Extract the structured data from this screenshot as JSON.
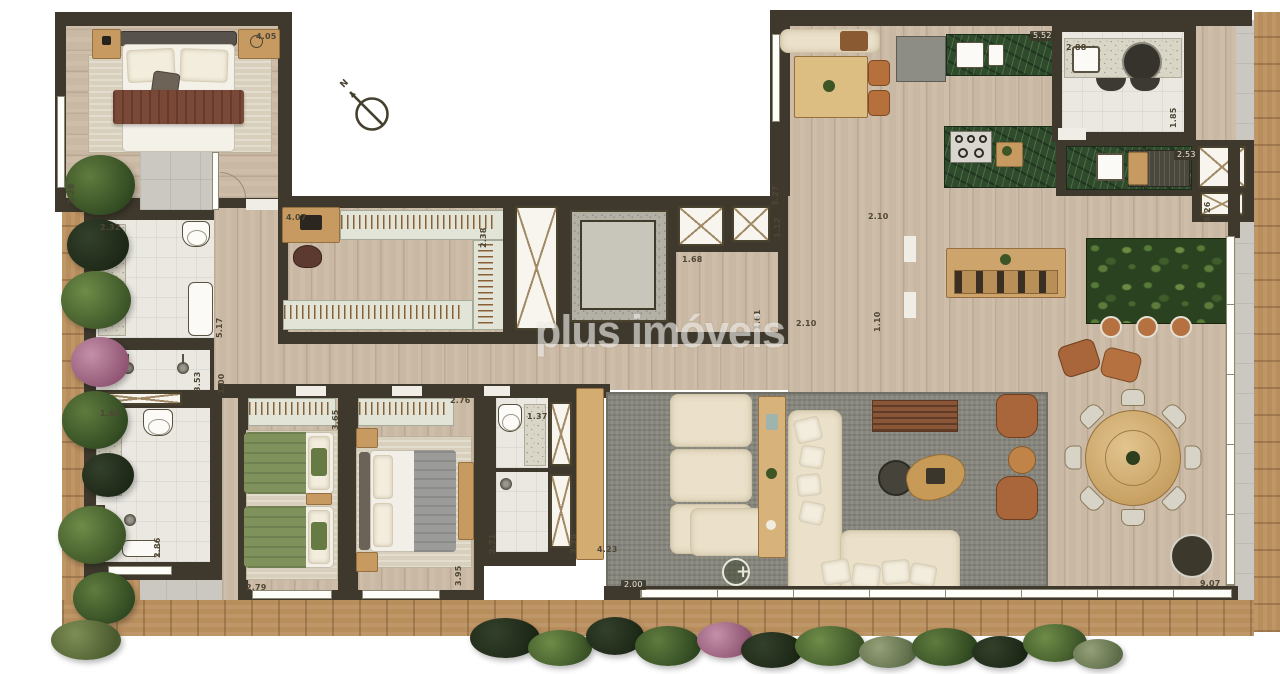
{
  "watermark": "plus imóveis",
  "compass": {
    "label": "N"
  },
  "garden_marker": "+",
  "colors": {
    "wall": "#3e392c",
    "wood": "#c9b8a3",
    "wood2": "#c79a62",
    "deck": "#b98e5d",
    "tile": "#cac8c1",
    "wtile": "#eae8e1",
    "marble": "#2e4b2c",
    "grass": "#2b3d1d",
    "ruggray": "#87877e",
    "rugbeige": "#d8d0bc",
    "sofa": "#ebe1ca",
    "bedgreen": "#7f925c",
    "bedgray": "#9b9b99",
    "blanket": "#7a4836",
    "watermark_color": "#ffffff"
  },
  "dimensions": [
    {
      "value": "4.05",
      "x": 256,
      "y": 33
    },
    {
      "value": "3.28",
      "x": 76,
      "y": 196,
      "rot": 1
    },
    {
      "value": "2.32",
      "x": 100,
      "y": 224
    },
    {
      "value": "4.07",
      "x": 286,
      "y": 214
    },
    {
      "value": "2.38",
      "x": 488,
      "y": 240,
      "rot": 1
    },
    {
      "value": "5.17",
      "x": 224,
      "y": 330,
      "rot": 1
    },
    {
      "value": "1.68",
      "x": 682,
      "y": 256
    },
    {
      "value": "3.27",
      "x": 780,
      "y": 198,
      "rot": 1
    },
    {
      "value": "1.12",
      "x": 782,
      "y": 230,
      "rot": 1
    },
    {
      "value": "2.10",
      "x": 868,
      "y": 213
    },
    {
      "value": "2.10",
      "x": 796,
      "y": 320
    },
    {
      "value": "1.10",
      "x": 882,
      "y": 324,
      "rot": 1
    },
    {
      "value": "1.61",
      "x": 762,
      "y": 322,
      "rot": 1
    },
    {
      "value": "5.52",
      "x": 1030,
      "y": 31,
      "tag": 1
    },
    {
      "value": "2.88",
      "x": 1066,
      "y": 44
    },
    {
      "value": "1.85",
      "x": 1178,
      "y": 120,
      "rot": 1
    },
    {
      "value": "2.53",
      "x": 1174,
      "y": 150,
      "tag": 1
    },
    {
      "value": "8.26",
      "x": 1212,
      "y": 214,
      "rot": 1
    },
    {
      "value": "3.53",
      "x": 202,
      "y": 384,
      "rot": 1
    },
    {
      "value": "1.00",
      "x": 226,
      "y": 386,
      "rot": 1
    },
    {
      "value": "1.64",
      "x": 100,
      "y": 410
    },
    {
      "value": "2.86",
      "x": 162,
      "y": 550,
      "rot": 1
    },
    {
      "value": "2.79",
      "x": 246,
      "y": 584
    },
    {
      "value": "3.65",
      "x": 340,
      "y": 422,
      "rot": 1
    },
    {
      "value": "2.76",
      "x": 450,
      "y": 397
    },
    {
      "value": "1.37",
      "x": 527,
      "y": 413
    },
    {
      "value": "2.71",
      "x": 497,
      "y": 546,
      "rot": 1
    },
    {
      "value": "3.38",
      "x": 578,
      "y": 546,
      "rot": 1
    },
    {
      "value": "4.23",
      "x": 597,
      "y": 546
    },
    {
      "value": "2.00",
      "x": 621,
      "y": 580,
      "tag": 1
    },
    {
      "value": "9.07",
      "x": 1200,
      "y": 580
    },
    {
      "value": "3.95",
      "x": 463,
      "y": 578,
      "rot": 1
    }
  ]
}
